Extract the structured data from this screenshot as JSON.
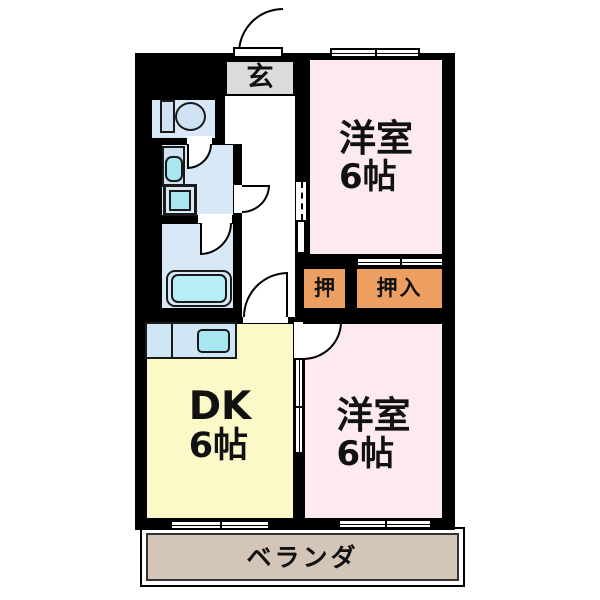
{
  "plan": {
    "genkan": {
      "label": "玄"
    },
    "bedroom_top": {
      "name": "洋室",
      "size": "6帖"
    },
    "bedroom_bottom": {
      "name": "洋室",
      "size": "6帖"
    },
    "dk": {
      "name": "DK",
      "size": "6帖"
    },
    "closet_small": {
      "label": "押"
    },
    "closet_large": {
      "label": "押入"
    },
    "veranda": {
      "label": "ベランダ"
    }
  },
  "colors": {
    "wall": "#000000",
    "bedroom_pink": "#fce9f2",
    "dk_yellow": "#fcf9c9",
    "closet_orange": "#ec9f61",
    "wet_area_blue": "#d8e8f7",
    "fixture_cyan": "#a8e6f0",
    "tub_cyan": "#b5eef6",
    "counter_blue": "#cfe7f5",
    "genkan_gray": "#dbdbdb",
    "veranda_tan": "#d3c5b8"
  }
}
